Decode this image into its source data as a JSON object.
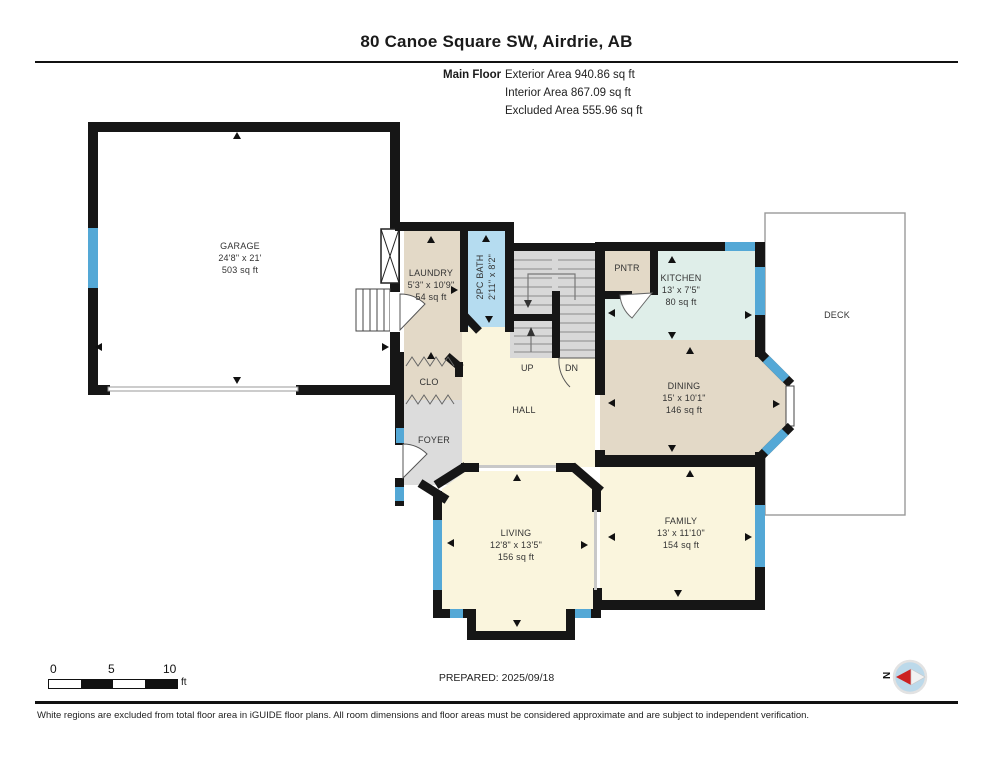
{
  "header": {
    "title": "80 Canoe Square SW, Airdrie, AB",
    "floor_label": "Main Floor",
    "stats": [
      "Exterior Area 940.86 sq ft",
      "Interior Area 867.09 sq ft",
      "Excluded Area 555.96 sq ft"
    ]
  },
  "rooms": {
    "garage": {
      "name": "GARAGE",
      "dims": "24'8\" x 21'",
      "area": "503 sq ft"
    },
    "laundry": {
      "name": "LAUNDRY",
      "dims": "5'3\" x 10'9\"",
      "area": "54 sq ft"
    },
    "bath": {
      "name": "2PC BATH",
      "dims": "2'11\" x 8'2\""
    },
    "pantry": {
      "name": "PNTR"
    },
    "kitchen": {
      "name": "KITCHEN",
      "dims": "13' x 7'5\"",
      "area": "80 sq ft"
    },
    "deck": {
      "name": "DECK"
    },
    "dining": {
      "name": "DINING",
      "dims": "15' x 10'1\"",
      "area": "146 sq ft"
    },
    "hall": {
      "name": "HALL"
    },
    "closet": {
      "name": "CLO"
    },
    "foyer": {
      "name": "FOYER"
    },
    "living": {
      "name": "LIVING",
      "dims": "12'8\" x 13'5\"",
      "area": "156 sq ft"
    },
    "family": {
      "name": "FAMILY",
      "dims": "13' x 11'10\"",
      "area": "154 sq ft"
    },
    "stairs": {
      "up": "UP",
      "down": "DN"
    }
  },
  "scale_bar": {
    "labels": [
      "0",
      "5",
      "10"
    ],
    "unit": "ft"
  },
  "footer": {
    "prepared": "PREPARED: 2025/09/18",
    "disclaimer": "White regions are excluded from total floor area in iGUIDE floor plans. All room dimensions and floor areas must be considered approximate and are subject to independent verification.",
    "compass_label": "N"
  },
  "colors": {
    "wall": "#161616",
    "window": "#54a8d6",
    "room_tan": "#e3d9c7",
    "room_cream": "#faf5dd",
    "room_mint": "#dfeee9",
    "room_blue": "#b5dcf0",
    "room_gray": "#dcdcdc",
    "stairs_gray": "#d8d8d8"
  }
}
